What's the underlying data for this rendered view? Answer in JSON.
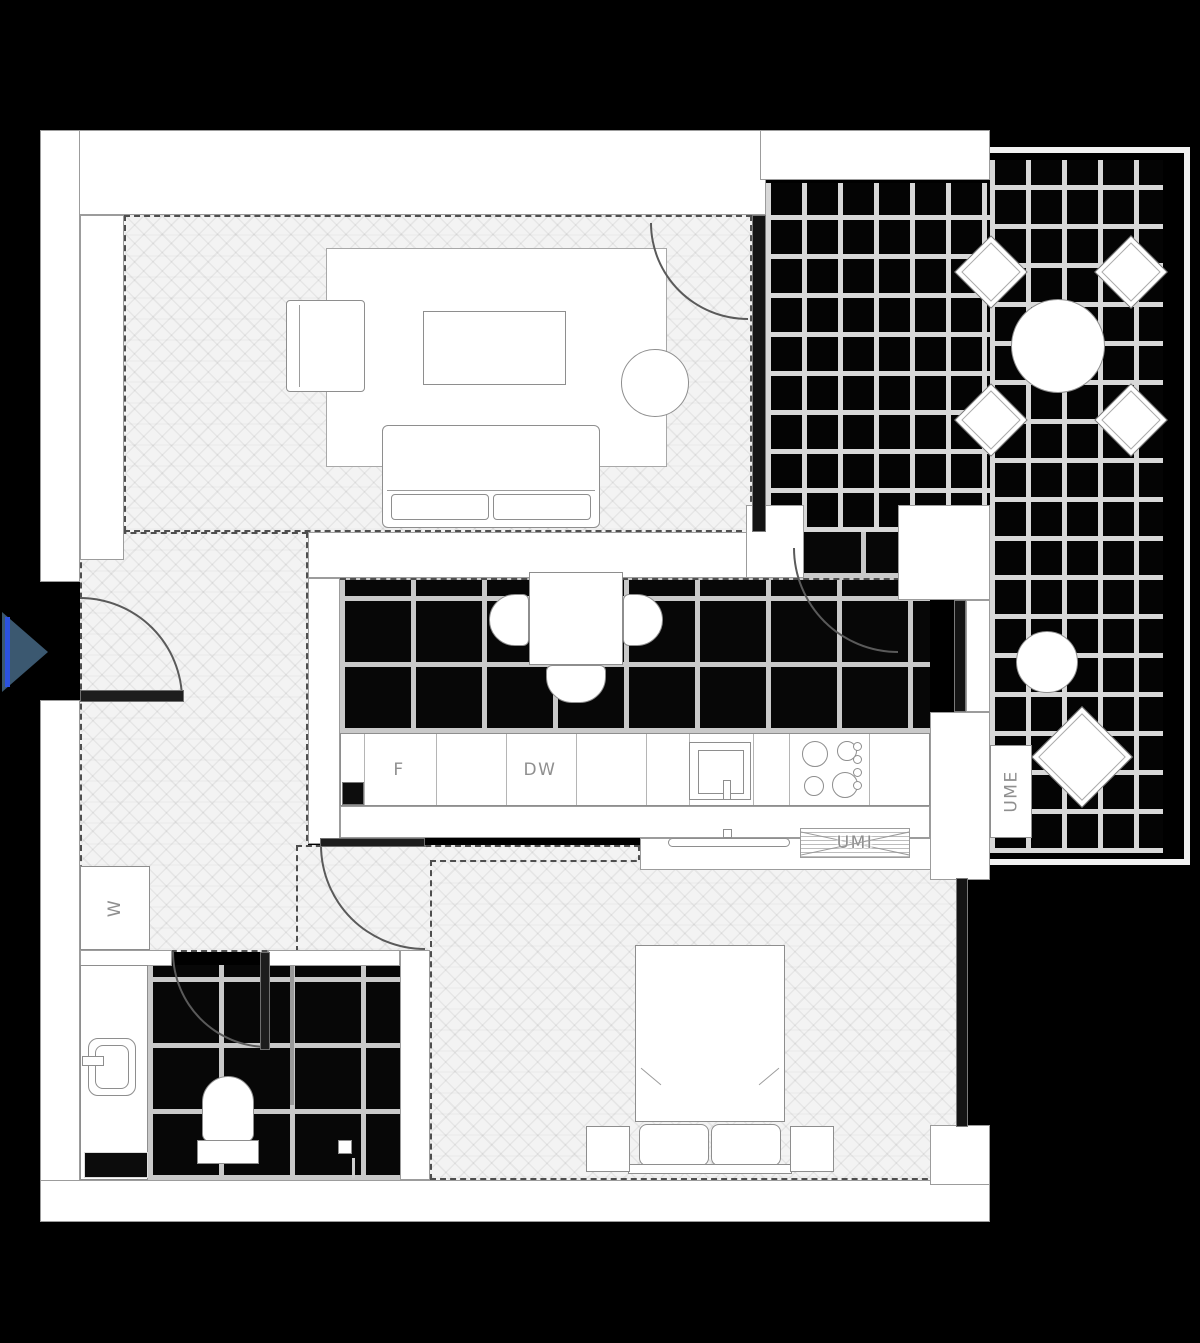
{
  "labels": {
    "radiator_living": "UMI",
    "radiator_kitchen": "UMI",
    "fridge": "F",
    "dishwasher": "DW",
    "outdoor_unit": "UME",
    "washer": "W"
  },
  "colors": {
    "background": "#000000",
    "wall": "#ffffff",
    "label_text": "#8f8f8f",
    "entry_arrow_fill": "#3b5870",
    "entry_arrow_line": "#2b52e0"
  }
}
